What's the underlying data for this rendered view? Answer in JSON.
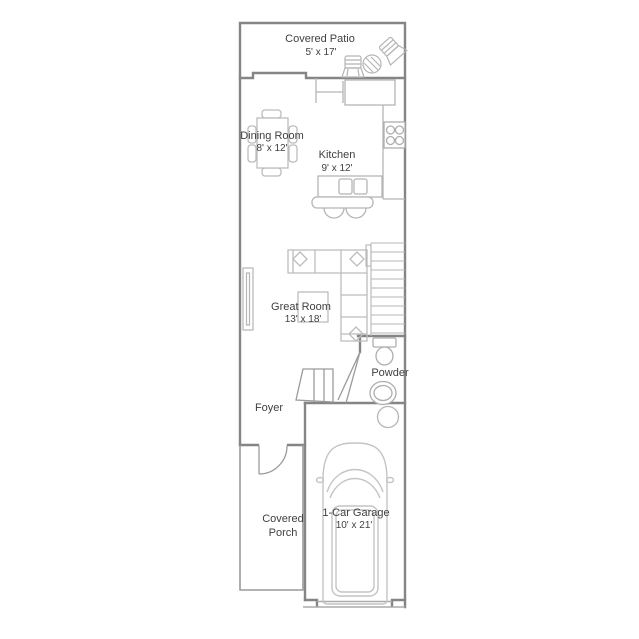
{
  "plan": {
    "type": "residential-floor-plan",
    "rooms": {
      "patio": {
        "name": "Covered Patio",
        "dims": "5' x 17'"
      },
      "dining": {
        "name": "Dining Room",
        "dims": "8' x 12'"
      },
      "kitchen": {
        "name": "Kitchen",
        "dims": "9' x 12'"
      },
      "great_room": {
        "name": "Great Room",
        "dims": "13' x 18'"
      },
      "powder": {
        "name": "Powder"
      },
      "foyer": {
        "name": "Foyer"
      },
      "porch": {
        "line1": "Covered",
        "line2": "Porch"
      },
      "garage": {
        "name": "1-Car Garage",
        "dims": "10' x 21'"
      }
    },
    "colors": {
      "wall": "#858585",
      "furniture": "#bcbcbc",
      "fixture": "#ababab",
      "text": "#3f3f3f",
      "background": "#ffffff"
    }
  }
}
